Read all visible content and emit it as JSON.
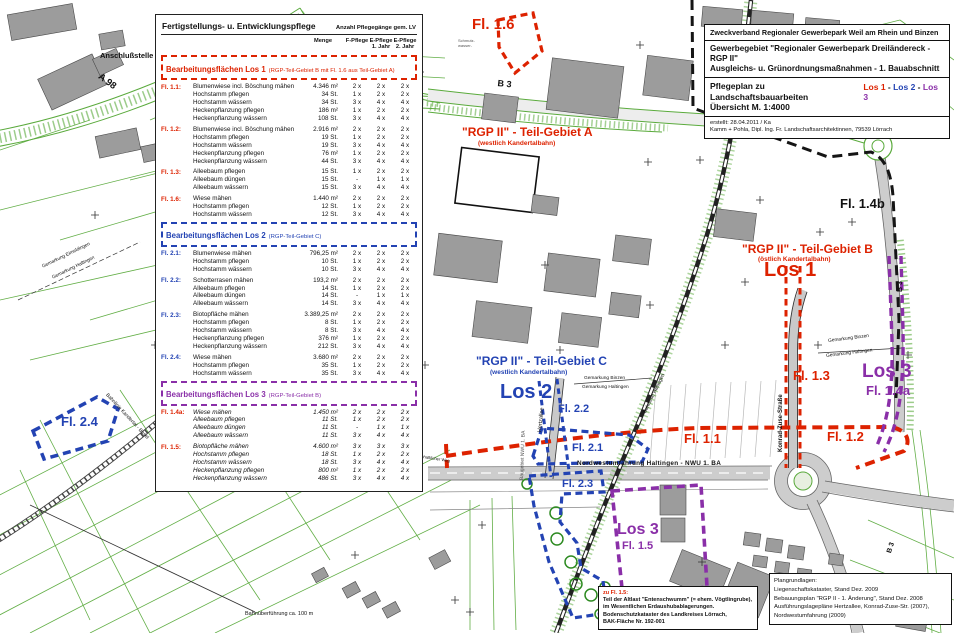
{
  "title_block": {
    "line1": "Zweckverband Regionaler Gewerbepark Weil am Rhein und Binzen",
    "line2a": "Gewerbegebiet \"Regionaler Gewerbepark Dreiländereck - RGP II\"",
    "line2b": "Ausgleichs- u. Grünordnungsmaßnahmen - 1. Bauabschnitt",
    "line3a": "Pflegeplan zu Landschaftsbauarbeiten",
    "line3b": "Übersicht M. 1:4000",
    "lots": [
      {
        "label": "Los 1",
        "color": "#dd2200"
      },
      {
        "label": "Los 2",
        "color": "#2343b3"
      },
      {
        "label": "Los 3",
        "color": "#8a2fa8"
      }
    ],
    "lot_separator": " - ",
    "created": "erstellt:  28.04.2011 / Ka",
    "author": "Kamm + Pohla, Dipl. Ing. Fr. Landschaftsarchitektinnen, 79539 Lörrach"
  },
  "care_table": {
    "title": "Fertigstellungs-  u. Entwicklungspflege",
    "title_right": "Anzahl Pflegegänge gem. LV",
    "col_headers": {
      "menge": "Menge",
      "f": "F-Pflege",
      "e1a": "E-Pflege",
      "e1b": "1. Jahr",
      "e2a": "E-Pflege",
      "e2b": "2. Jahr"
    },
    "sections": [
      {
        "heading": "Bearbeitungsflächen  Los 1",
        "heading_note": "(RGP-Teil-Gebiet B  mit Fl. 1.6 aus Teil-Gebiet A)",
        "color": "#dd2200",
        "label_color": "#dd2200",
        "italic": false,
        "groups": [
          {
            "label": "Fl. 1.1:",
            "rows": [
              [
                "Blumenwiese incl. Böschung mähen",
                "4.346 m²",
                "2 x",
                "2 x",
                "2 x"
              ],
              [
                "Hochstamm pflegen",
                "34 St.",
                "1 x",
                "2 x",
                "2 x"
              ],
              [
                "Hochstamm wässern",
                "34 St.",
                "3 x",
                "4 x",
                "4 x"
              ],
              [
                "Heckenpflanzung pflegen",
                "186 m²",
                "1 x",
                "2 x",
                "2 x"
              ],
              [
                "Heckenpflanzung wässern",
                "108 St.",
                "3 x",
                "4 x",
                "4 x"
              ]
            ]
          },
          {
            "label": "Fl. 1.2:",
            "rows": [
              [
                "Blumenwiese incl. Böschung mähen",
                "2.916 m²",
                "2 x",
                "2 x",
                "2 x"
              ],
              [
                "Hochstamm pflegen",
                "19 St.",
                "1 x",
                "2 x",
                "2 x"
              ],
              [
                "Hochstamm wässern",
                "19 St.",
                "3 x",
                "4 x",
                "4 x"
              ],
              [
                "Heckenpflanzung pflegen",
                "76 m²",
                "1 x",
                "2 x",
                "2 x"
              ],
              [
                "Heckenpflanzung wässern",
                "44 St.",
                "3 x",
                "4 x",
                "4 x"
              ]
            ]
          },
          {
            "label": "Fl. 1.3:",
            "rows": [
              [
                "Alleebaum pflegen",
                "15 St.",
                "1 x",
                "2 x",
                "2 x"
              ],
              [
                "Alleebaum düngen",
                "15 St.",
                "-",
                "1 x",
                "1 x"
              ],
              [
                "Alleebaum wässern",
                "15 St.",
                "3 x",
                "4 x",
                "4 x"
              ]
            ]
          },
          {
            "label": "Fl. 1.6:",
            "rows": [
              [
                "Wiese mähen",
                "1.440 m²",
                "2 x",
                "2 x",
                "2 x"
              ],
              [
                "Hochstamm pflegen",
                "12 St.",
                "1 x",
                "2 x",
                "2 x"
              ],
              [
                "Hochstamm wässern",
                "12 St.",
                "3 x",
                "4 x",
                "4 x"
              ]
            ]
          }
        ]
      },
      {
        "heading": "Bearbeitungsflächen  Los 2",
        "heading_note": "(RGP-Teil-Gebiet C)",
        "color": "#2343b3",
        "label_color": "#2343b3",
        "italic": false,
        "groups": [
          {
            "label": "Fl. 2.1:",
            "rows": [
              [
                "Blumenwiese mähen",
                "796,25 m²",
                "2 x",
                "2 x",
                "2 x"
              ],
              [
                "Hochstamm pflegen",
                "10 St.",
                "1 x",
                "2 x",
                "2 x"
              ],
              [
                "Hochstamm wässern",
                "10 St.",
                "3 x",
                "4 x",
                "4 x"
              ]
            ]
          },
          {
            "label": "Fl. 2.2:",
            "rows": [
              [
                "Schotterrasen mähen",
                "193,2 m²",
                "2 x",
                "2 x",
                "2 x"
              ],
              [
                "Alleebaum pflegen",
                "14 St.",
                "1 x",
                "2 x",
                "2 x"
              ],
              [
                "Alleebaum düngen",
                "14 St.",
                "-",
                "1 x",
                "1 x"
              ],
              [
                "Alleebaum wässern",
                "14 St.",
                "3 x",
                "4 x",
                "4 x"
              ]
            ]
          },
          {
            "label": "Fl. 2.3:",
            "rows": [
              [
                "Biotopfläche mähen",
                "3.389,25 m²",
                "2 x",
                "2 x",
                "2 x"
              ],
              [
                "Hochstamm pflegen",
                "8 St.",
                "1 x",
                "2 x",
                "2 x"
              ],
              [
                "Hochstamm wässern",
                "8 St.",
                "3 x",
                "4 x",
                "4 x"
              ],
              [
                "Heckenpflanzung pflegen",
                "376 m²",
                "1 x",
                "2 x",
                "2 x"
              ],
              [
                "Heckenpflanzung wässern",
                "212 St.",
                "3 x",
                "4 x",
                "4 x"
              ]
            ]
          },
          {
            "label": "Fl. 2.4:",
            "rows": [
              [
                "Wiese mähen",
                "3.680 m²",
                "2 x",
                "2 x",
                "2 x"
              ],
              [
                "Hochstamm pflegen",
                "35 St.",
                "1 x",
                "2 x",
                "2 x"
              ],
              [
                "Hochstamm wässern",
                "35 St.",
                "3 x",
                "4 x",
                "4 x"
              ]
            ]
          }
        ]
      },
      {
        "heading": "Bearbeitungsflächen  Los 3",
        "heading_note": "(RGP-Teil-Gebiet B)",
        "color": "#8a2fa8",
        "label_color": "#dd2200",
        "italic": true,
        "groups": [
          {
            "label": "Fl. 1.4a:",
            "rows": [
              [
                "Wiese mähen",
                "1.450 m²",
                "2 x",
                "2 x",
                "2 x"
              ],
              [
                "Alleebaum pflegen",
                "11 St.",
                "1 x",
                "2 x",
                "2 x"
              ],
              [
                "Alleebaum düngen",
                "11 St.",
                "-",
                "1 x",
                "1 x"
              ],
              [
                "Alleebaum wässern",
                "11 St.",
                "3 x",
                "4 x",
                "4 x"
              ]
            ]
          },
          {
            "label": "Fl. 1.5:",
            "rows": [
              [
                "Biotopfläche mähen",
                "4.600 m²",
                "3 x",
                "3 x",
                "3 x"
              ],
              [
                "Hochstamm pflegen",
                "18 St.",
                "1 x",
                "2 x",
                "2 x"
              ],
              [
                "Hochstamm wässern",
                "18 St.",
                "3 x",
                "4 x",
                "4 x"
              ],
              [
                "Heckenpflanzung pflegen",
                "800 m²",
                "1 x",
                "2 x",
                "2 x"
              ],
              [
                "Heckenpflanzung wässern",
                "486 St.",
                "3 x",
                "4 x",
                "4 x"
              ]
            ]
          }
        ]
      }
    ]
  },
  "map_labels": {
    "fl_1_6": "Fl. 1.6",
    "area_a_title": "\"RGP II\" - Teil-Gebiet A",
    "area_a_sub": "(westlich Kandertalbahn)",
    "area_b_title": "\"RGP II\" - Teil-Gebiet B",
    "area_b_sub": "(östlich Kandertalbahn)",
    "los_1": "Los 1",
    "fl_1_4b": "Fl. 1.4b",
    "area_c_title": "\"RGP II\" - Teil-Gebiet C",
    "area_c_sub": "(westlich Kandertalbahn)",
    "los_2": "Los 2",
    "fl_1_3": "Fl. 1.3",
    "los_3_right": "Los 3",
    "fl_1_4a": "Fl. 1.4a",
    "fl_1_1": "Fl. 1.1",
    "fl_1_2": "Fl. 1.2",
    "fl_2_2": "Fl. 2.2",
    "fl_2_1": "Fl. 2.1",
    "fl_2_3": "Fl. 2.3",
    "los_3_bottom": "Los 3",
    "fl_1_5": "Fl. 1.5",
    "fl_2_4": "Fl. 2.4",
    "road_nwu": "Nordwestumfahrung Haltingen - NWU 1. BA",
    "road_kzs": "Konrad-Zuse-Straße",
    "road_hertzallee": "Hertzallee",
    "baugebiet": "Baugebiet NWU 1. BA",
    "bahn_haltingen": "Bahnlinie Haltingen",
    "bahn_kandertal": "Bahnlinie Kandertal - Basel",
    "gem_eimeldingen": "Gemarkung Eimeldingen",
    "gem_haltingen_left": "Gemarkung Haltingen",
    "gem_binzen_center": "Gemarkung Binzen",
    "gem_haltingen_center": "Gemarkung Haltingen",
    "gem_binzen_right": "Gemarkung Binzen",
    "gem_haltingen_right": "Gemarkung Haltingen",
    "anschlussstelle": "Anschlußstelle",
    "road_a98": "A 98",
    "road_b3_top": "B 3",
    "road_b3_right": "B 3",
    "road_b3_bottom": "B 3",
    "road_l134": "L 134",
    "bahnueberfuehrung": "Bahnüberführung ca. 100 m",
    "landw_weg": "Landwirtschaftlicher Weg",
    "schmutz_1": "Schmutz-",
    "schmutz_2": "wasser-"
  },
  "notes": {
    "altlast": {
      "title": "zu Fl. 1.5:",
      "lines": [
        "Teil der Altlast \"Entenschwumm\" (= ehem. Vögtlingrube),",
        "im Wesentlichen Erdaushubablagerungen.",
        "Bodenschutzkataster des Landkreises Lörrach,",
        "BAK-Fläche Nr. 192-001"
      ]
    },
    "plangrundlagen": {
      "title": "Plangrundlagen:",
      "lines": [
        "Liegenschaftskataster, Stand Dez. 2009",
        "Bebauungsplan \"RGP II - 1. Änderung\", Stand Dez. 2008",
        "Ausführungslagepläne Hertzallee, Konrad-Zuse-Str. (2007),",
        "Nordwestumfahrung (2009)"
      ]
    }
  },
  "colors": {
    "los1": "#dd2200",
    "los2": "#2343b3",
    "los3": "#8a2fa8",
    "parcel_green": "#5aaa3c",
    "building_gray": "#9c9c9c"
  }
}
